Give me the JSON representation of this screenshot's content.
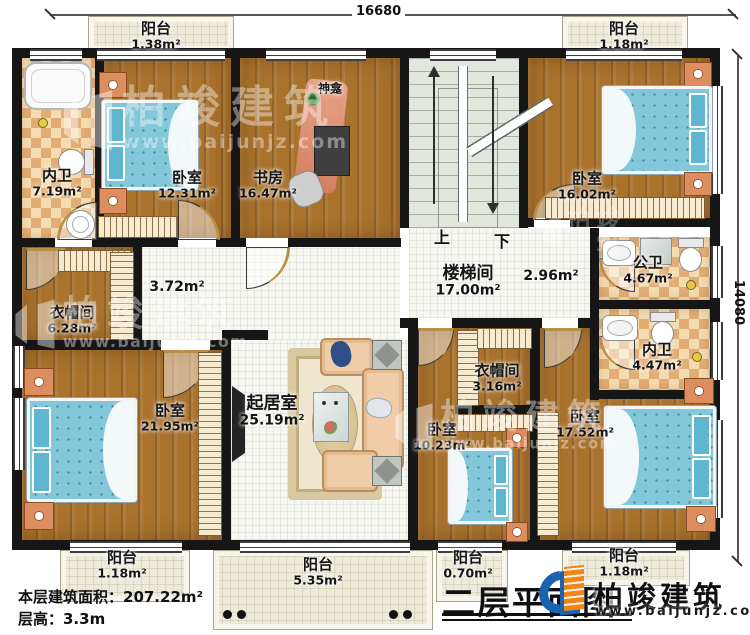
{
  "dims": {
    "top": "16680",
    "right": "14080"
  },
  "rooms": {
    "balcony_tl": {
      "name": "阳台",
      "area": "1.38m²"
    },
    "balcony_tr": {
      "name": "阳台",
      "area": "1.18m²"
    },
    "bath_tl": {
      "name": "内卫",
      "area": "7.19m²"
    },
    "bedroom_tl": {
      "name": "卧室",
      "area": "12.31m²"
    },
    "study": {
      "name": "书房",
      "area": "16.47m²"
    },
    "shrine": {
      "name": "神龛"
    },
    "stairhall": {
      "name": "楼梯间",
      "area": "17.00m²"
    },
    "hall_right": {
      "area": "2.96m²"
    },
    "hall_left": {
      "area": "3.72m²"
    },
    "bedroom_tr": {
      "name": "卧室",
      "area": "16.02m²"
    },
    "bath_public": {
      "name": "公卫",
      "area": "4.67m²"
    },
    "bath_right": {
      "name": "内卫",
      "area": "4.47m²"
    },
    "cloak_left": {
      "name": "衣帽间",
      "area": "6.28m²"
    },
    "bedroom_bl": {
      "name": "卧室",
      "area": "21.95m²"
    },
    "living": {
      "name": "起居室",
      "area": "25.19m²"
    },
    "cloak_center": {
      "name": "衣帽间",
      "area": "3.16m²"
    },
    "bedroom_bc": {
      "name": "卧室",
      "area": "10.23m²"
    },
    "bedroom_br": {
      "name": "卧室",
      "area": "17.52m²"
    },
    "balcony_bl": {
      "name": "阳台",
      "area": "1.18m²"
    },
    "balcony_bc": {
      "name": "阳台",
      "area": "5.35m²"
    },
    "balcony_bs": {
      "name": "阳台",
      "area": "0.70m²"
    },
    "balcony_br": {
      "name": "阳台",
      "area": "1.18m²"
    }
  },
  "stairs": {
    "up": "上",
    "down": "下"
  },
  "footer": {
    "area_line": "本层建筑面积：207.22m²",
    "height_line": "层高：3.3m"
  },
  "title": "二层平面图",
  "brand": {
    "name": "柏竣建筑",
    "url": "www.baijunjz.com"
  }
}
